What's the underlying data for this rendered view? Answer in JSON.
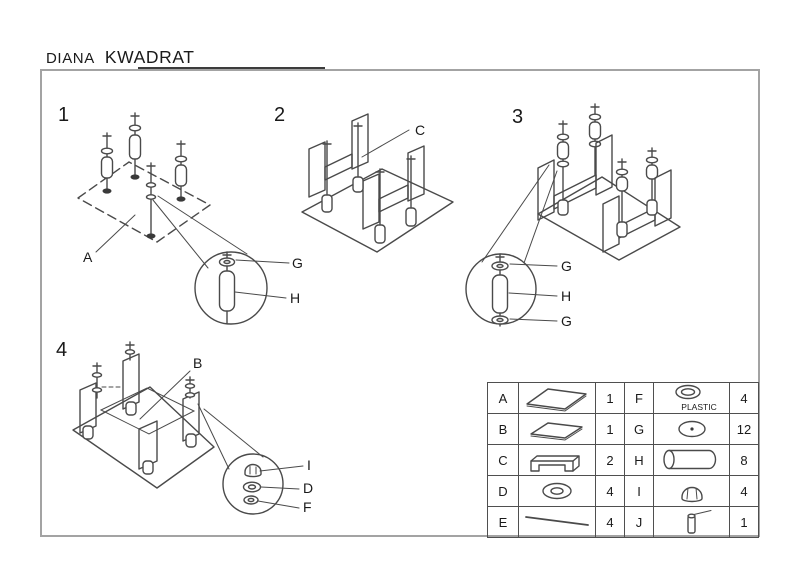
{
  "title": {
    "model": "DIANA",
    "variant": "KWADRAT"
  },
  "steps": {
    "step1": {
      "number": "1",
      "label_a": "A",
      "label_g": "G",
      "label_h": "H"
    },
    "step2": {
      "number": "2",
      "label_c": "C"
    },
    "step3": {
      "number": "3",
      "label_g_top": "G",
      "label_h": "H",
      "label_g_bottom": "G"
    },
    "step4": {
      "number": "4",
      "label_b": "B",
      "label_i": "I",
      "label_d": "D",
      "label_f": "F"
    }
  },
  "parts_table": {
    "rows": [
      {
        "letter": "A",
        "qty": "1",
        "icon": "glass-top-icon"
      },
      {
        "letter": "B",
        "qty": "1",
        "icon": "glass-shelf-icon"
      },
      {
        "letter": "C",
        "qty": "2",
        "icon": "u-bracket-icon"
      },
      {
        "letter": "D",
        "qty": "4",
        "icon": "washer-ring-icon"
      },
      {
        "letter": "E",
        "qty": "4",
        "icon": "threaded-rod-icon"
      },
      {
        "letter": "F",
        "qty": "4",
        "icon": "plastic-washer-icon",
        "note": "PLASTIC"
      },
      {
        "letter": "G",
        "qty": "12",
        "icon": "disc-washer-icon"
      },
      {
        "letter": "H",
        "qty": "8",
        "icon": "spacer-tube-icon"
      },
      {
        "letter": "I",
        "qty": "4",
        "icon": "dome-cap-nut-icon"
      },
      {
        "letter": "J",
        "qty": "1",
        "icon": "assembly-key-icon"
      }
    ]
  }
}
